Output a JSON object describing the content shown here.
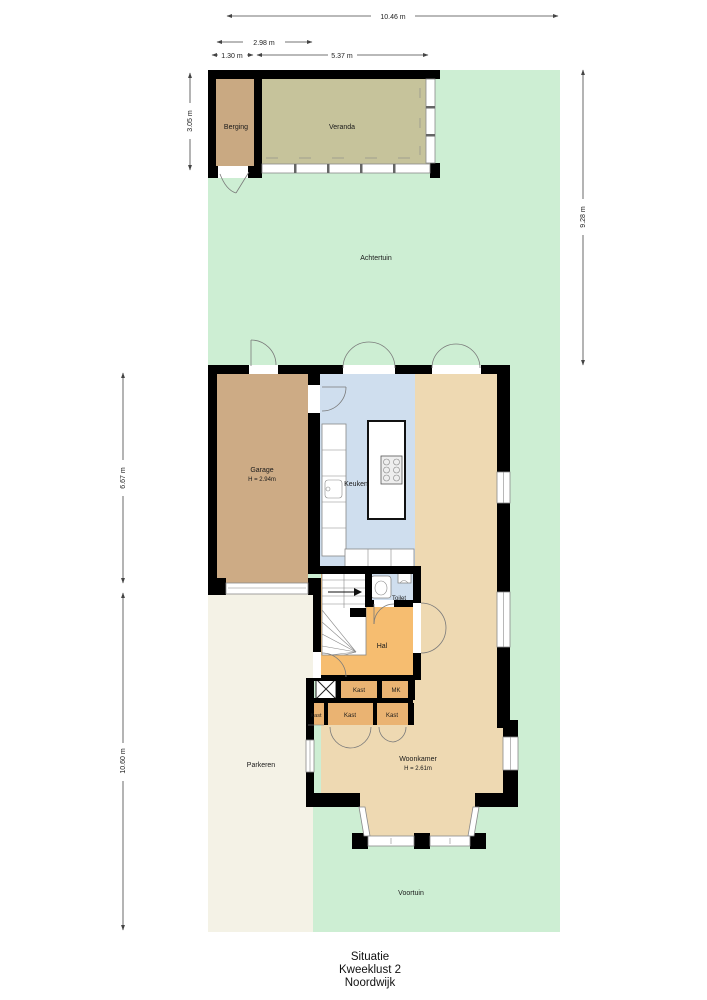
{
  "plan": {
    "title_line1": "Situatie",
    "title_line2": "Kweeklust 2",
    "title_line3": "Noordwijk"
  },
  "rooms": {
    "berging": "Berging",
    "veranda": "Veranda",
    "achtertuin": "Achtertuin",
    "garage": "Garage",
    "garage_height": "H = 2.94m",
    "keuken": "Keuken",
    "toilet": "Toilet",
    "hal": "Hal",
    "kast": "Kast",
    "mk": "MK",
    "woonkamer": "Woonkamer",
    "woonkamer_height": "H = 2.61m",
    "parkeren": "Parkeren",
    "voortuin": "Voortuin"
  },
  "dimensions": {
    "total_width": "10.46 m",
    "berging_width": "2.98 m",
    "left_width": "1.30 m",
    "veranda_width": "5.37 m",
    "top_building_depth": "3.05 m",
    "achtertuin_depth": "9.28 m",
    "house_depth": "6.67 m",
    "front_depth": "10.60 m"
  },
  "colors": {
    "garden": "#cdeed3",
    "paving": "#f4f2e6",
    "berging": "#c9a982",
    "veranda": "#c6c39b",
    "garage": "#cdab85",
    "kitchen": "#cfdeee",
    "living": "#eed9b2",
    "hall": "#f6bd70",
    "closet": "#eab372",
    "wall": "#000000"
  }
}
